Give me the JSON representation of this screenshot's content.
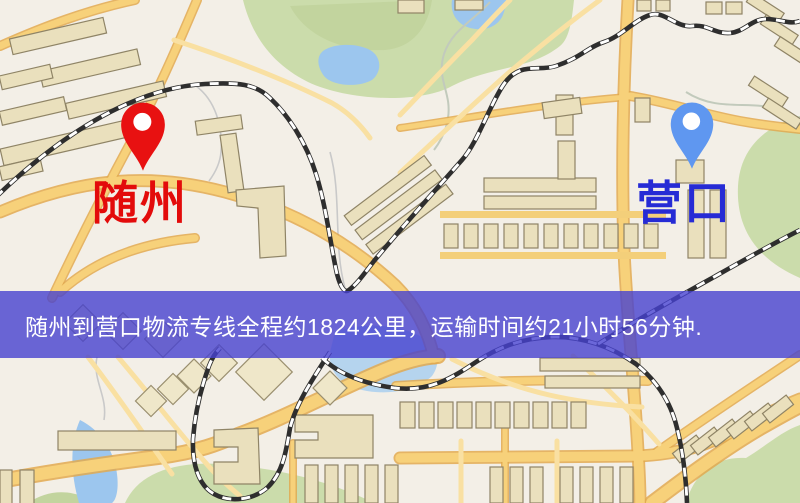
{
  "banner": {
    "text": "随州到营口物流专线全程约1824公里，运输时间约21小时56分钟.",
    "background": "#4641d0",
    "text_color": "#ffffff"
  },
  "markers": {
    "origin": {
      "label": "随州",
      "pin_color": "#e81111",
      "label_color": "#e30b0b"
    },
    "destination": {
      "label": "营口",
      "pin_color": "#5f97f0",
      "label_color": "#262bd5"
    }
  },
  "map_palette": {
    "background": "#f3efe7",
    "road_fill": "#f7d17a",
    "road_casing": "#e2a94f",
    "park": "#cbdcab",
    "water": "#9cc6ee",
    "building": "#eae0bd",
    "railway": "#2e2e2e"
  }
}
